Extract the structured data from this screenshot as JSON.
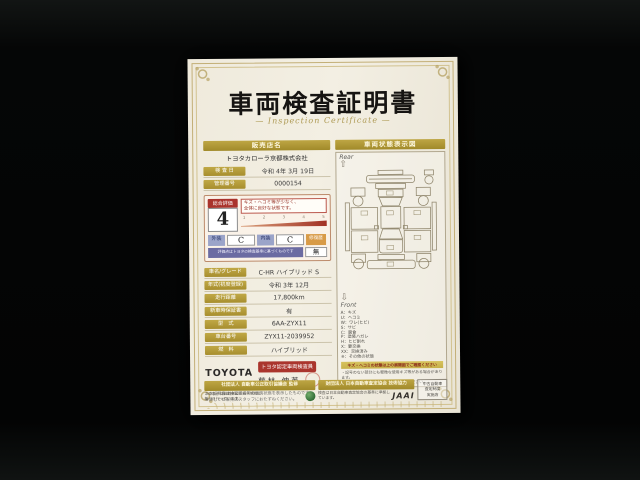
{
  "doc": {
    "title": "車両検査証明書",
    "subtitle": "— Inspection Certificate —",
    "left": {
      "dealer_header": "販売店名",
      "dealer_name": "トヨタカローラ京都株式会社",
      "meta": [
        {
          "label": "検 査 日",
          "value": "令和 4年 3月 19日"
        },
        {
          "label": "管理番号",
          "value": "0000154"
        }
      ],
      "evaluation": {
        "label": "総合評価",
        "score": "4",
        "note_line1": "キズ・ヘコミ等が少なく、",
        "note_line2": "全体に良好な状態です。",
        "scale_ticks": [
          "1",
          "2",
          "3",
          "4",
          "5"
        ],
        "exterior_label": "外装",
        "exterior_value": "C",
        "interior_label": "内装",
        "interior_value": "C",
        "repair_label": "修復歴",
        "repair_value": "無",
        "footnote": "評価点はトヨタの検査基準に基づくものです"
      },
      "specs": [
        {
          "label": "車名/グレード",
          "value": "C-HR ハイブリッド S"
        },
        {
          "label": "年式(初度登録)",
          "value": "令和 3年 12月"
        },
        {
          "label": "走行距離",
          "value": "17,800km"
        },
        {
          "label": "新車時保証書",
          "value": "有"
        },
        {
          "label": "型　式",
          "value": "6AA-ZYX11"
        },
        {
          "label": "車台番号",
          "value": "ZYX11-2039952"
        },
        {
          "label": "燃　料",
          "value": "ハイブリッド"
        }
      ],
      "inspector": {
        "brand": "TOYOTA",
        "badge": "トヨタ認定車両検査員",
        "name": "藤林 伸英"
      },
      "disclaimer_line1": "※本証明書は検査時点での車両状態を表示したものです。",
      "disclaimer_line2": "※詳しくは販売店スタッフにおたずねください。"
    },
    "right": {
      "header": "車両状態表示図",
      "rear_label": "Rear",
      "rear_arrow": "⇧",
      "front_label": "Front",
      "front_arrow": "⇩",
      "legend": [
        "A：キズ",
        "U：ヘコミ",
        "W：ワレ(ヒビ)",
        "S：サビ",
        "C：腐食",
        "P：塗装ハガレ",
        "H：ヒビ割れ",
        "X：要交換",
        "XX：交換済み",
        "※：その他の状態"
      ],
      "note_header": "キズ・ヘコミの状態は上の展開図でご確認ください",
      "note_line1": "・記号のない部分にも軽微な使用キズ等がある場合があります。",
      "note_line2": "・詳しくは販売店スタッフにおたずねください。"
    },
    "footer": {
      "fair_trade_bar": "社団法人 自動車公正取引協議会 監修",
      "fair_trade_line1": "この表示は自動車公正競争規約に",
      "fair_trade_line2": "基づき行っています。",
      "jaai_bar": "財団法人 日本自動車査定協会 技術協力",
      "jaai_line": "検査は日本自動車査定協会の基準に準拠しています。",
      "jaai_logo": "JAAI",
      "note_box_line1": "中古自動車",
      "note_box_line2": "査定制度",
      "note_box_line3": "実施店"
    }
  }
}
